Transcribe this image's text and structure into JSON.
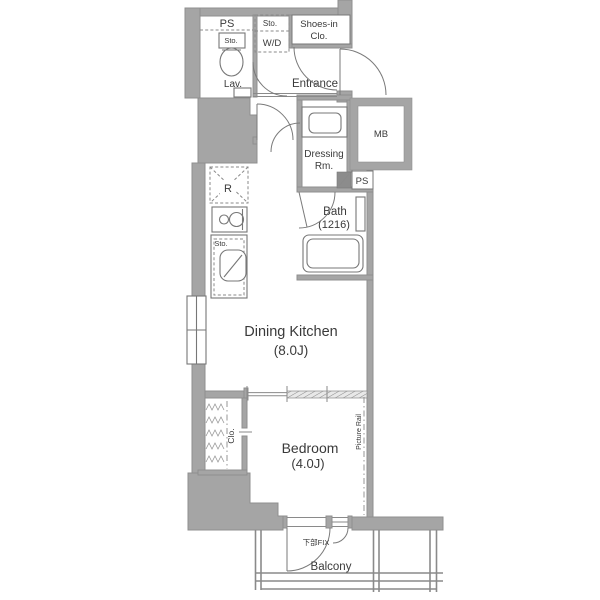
{
  "plan_title": "1K apartment floor plan",
  "rooms": {
    "dining_kitchen": {
      "name": "Dining Kitchen",
      "size": "(8.0J)"
    },
    "bedroom": {
      "name": "Bedroom",
      "size": "(4.0J)"
    },
    "bath": {
      "name": "Bath",
      "size": "(1216)"
    },
    "entrance": {
      "name": "Entrance"
    },
    "lavatory": {
      "name": "Lav."
    },
    "dressing_room": {
      "line1": "Dressing",
      "line2": "Rm."
    },
    "balcony": {
      "name": "Balcony"
    },
    "closet": {
      "name": "Clo."
    },
    "shoes_closet": {
      "line1": "Shoes-in",
      "line2": "Clo."
    },
    "washer_dryer": {
      "name": "W/D",
      "storage_label": "Sto."
    },
    "pipe_space_top": {
      "name": "PS"
    },
    "pipe_space_right": {
      "name": "PS"
    },
    "meter_box": {
      "name": "MB"
    }
  },
  "fixtures": {
    "refrigerator_symbol": "R",
    "kitchen_storage": "Sto.",
    "toilet_storage": "Sto.",
    "picture_rail": "Picture Rail",
    "fix_window": "下部FIX"
  },
  "colors": {
    "background": "#ffffff",
    "wall": "#a5a5a5",
    "wall_dark": "#8c8c8c",
    "line": "#777777",
    "text": "#3a3a3a"
  }
}
